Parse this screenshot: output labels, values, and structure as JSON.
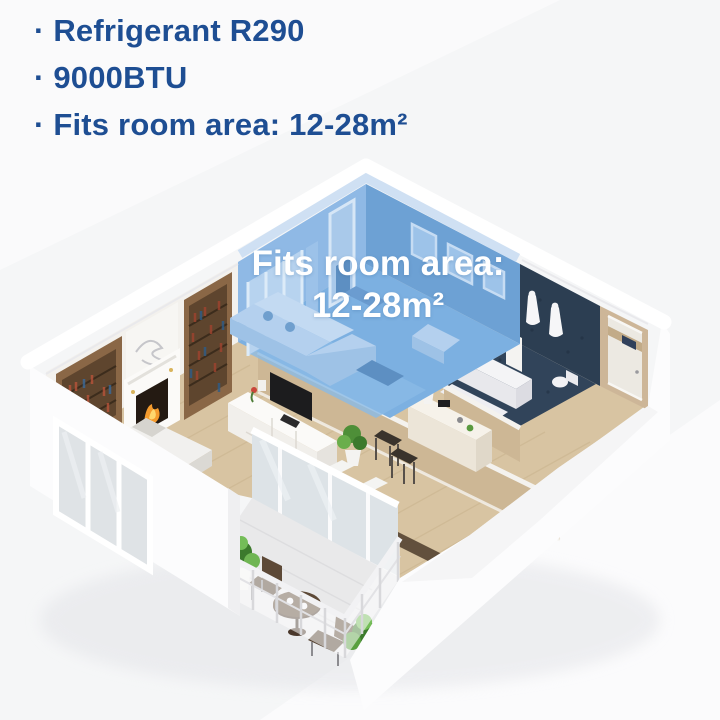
{
  "specs": {
    "items": [
      "· Refrigerant R290",
      "· 9000BTU",
      "· Fits room area: 12-28m²"
    ],
    "text_color": "#1e4e93"
  },
  "floorplan": {
    "label_line1": "Fits room area:",
    "label_line2": "12-28m²",
    "label_color": "#ffffff",
    "highlight_color": "#7aacdc",
    "rooms": {
      "highlighted_room": "living-room",
      "other_areas": [
        "bedroom",
        "bathroom",
        "hallway",
        "dining-area",
        "balcony"
      ]
    }
  },
  "palette": {
    "background": "#f5f6f7",
    "wood_floor": "#d8c4a2",
    "bathroom_tile_navy": "#2c3e52",
    "wall_tan": "#cdb795",
    "outer_wall_white": "#fcfcfd"
  }
}
